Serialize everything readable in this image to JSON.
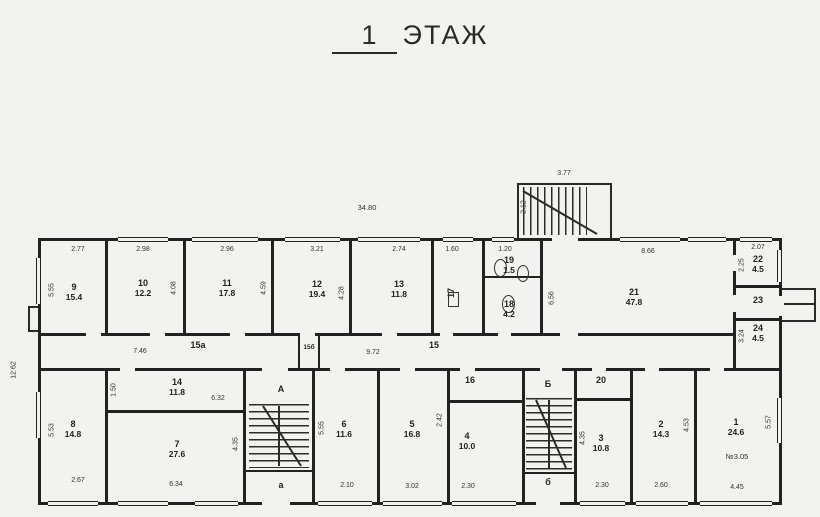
{
  "title": {
    "number": "1",
    "text": "ЭТАЖ"
  },
  "dims": {
    "overall_w": "34.80",
    "overall_h": "12.62",
    "porch_w": "3.77",
    "porch_d": "2.12",
    "top": {
      "r9": "2.77",
      "r10": "2.98",
      "r11": "2.96",
      "r12": "3.21",
      "r13": "2.74",
      "r17": "1.60",
      "r19": "1.20",
      "r21": "8.66",
      "r22": "2.07"
    },
    "bottom": {
      "r8": "2.67",
      "r7": "6.34",
      "r6": "2.10",
      "r5": "3.02",
      "r4": "2.30",
      "r3": "2.30",
      "r2": "2.60",
      "r1": "4.45"
    },
    "vert": {
      "r9": "5.55",
      "r10": "4.08",
      "r11": "4.59",
      "r12": "4.28",
      "r21": "6.56",
      "r22": "2.25",
      "r24": "3.24",
      "r8": "5.53",
      "r14": "1.50",
      "r7": "4.35",
      "r6": "5.55",
      "r5": "2.42",
      "r3": "4.35",
      "r2": "4.53",
      "r1": "5.57"
    },
    "corr": {
      "left": "7.46",
      "right": "9.72",
      "r14w": "6.32"
    }
  },
  "rooms": {
    "r1": {
      "num": "1",
      "area": "24.6",
      "note": "№3.05"
    },
    "r2": {
      "num": "2",
      "area": "14.3"
    },
    "r3": {
      "num": "3",
      "area": "10.8"
    },
    "r4": {
      "num": "4",
      "area": "10.0"
    },
    "r5": {
      "num": "5",
      "area": "16.8"
    },
    "r6": {
      "num": "6",
      "area": "11.6"
    },
    "r7": {
      "num": "7",
      "area": "27.6"
    },
    "r8": {
      "num": "8",
      "area": "14.8"
    },
    "r9": {
      "num": "9",
      "area": "15.4"
    },
    "r10": {
      "num": "10",
      "area": "12.2"
    },
    "r11": {
      "num": "11",
      "area": "17.8"
    },
    "r12": {
      "num": "12",
      "area": "19.4"
    },
    "r13": {
      "num": "13",
      "area": "11.8"
    },
    "r14": {
      "num": "14",
      "area": "11.8"
    },
    "r16": {
      "num": "16"
    },
    "r17": {
      "num": "17"
    },
    "r18": {
      "num": "18",
      "area": "4.2"
    },
    "r19": {
      "num": "19",
      "area": "1.5"
    },
    "r20": {
      "num": "20"
    },
    "r21": {
      "num": "21",
      "area": "47.8"
    },
    "r22": {
      "num": "22",
      "area": "4.5"
    },
    "r23": {
      "num": "23"
    },
    "r24": {
      "num": "24",
      "area": "4.5"
    }
  },
  "corridors": {
    "c15": "15",
    "c15a": "15а",
    "c15b": "15б"
  },
  "stairwells": {
    "a": "А",
    "a_exit": "а",
    "b": "Б",
    "b_exit": "б"
  }
}
